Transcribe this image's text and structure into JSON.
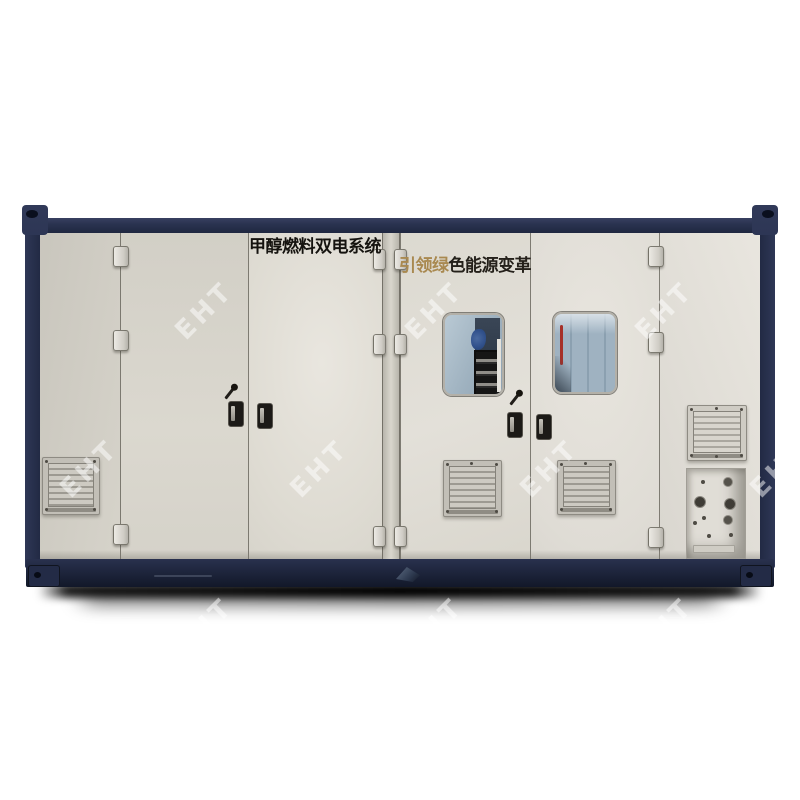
{
  "photo": {
    "banner_left": "甲醇燃料双电系统",
    "banner_right": {
      "highlight": "引领绿",
      "rest": "色能源变革",
      "highlight_color": "#a98950",
      "rest_color": "#24201a"
    },
    "watermark_text": "EHT",
    "colors": {
      "frame_navy": "#2a3350",
      "panel_beige": "#dbd8cf",
      "vent_gray": "#c2bfb7",
      "window_glass_blue": "#9fb2c0",
      "shadow_black": "#000000",
      "background": "#ffffff"
    }
  }
}
